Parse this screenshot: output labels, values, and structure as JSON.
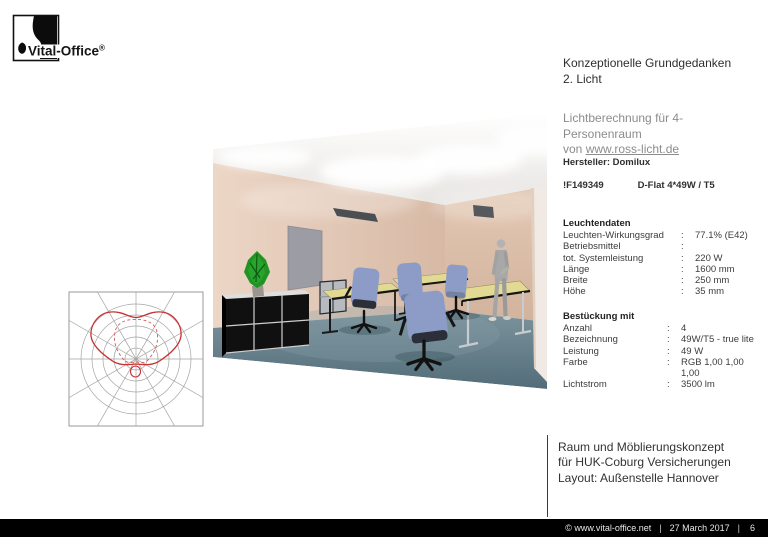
{
  "logo": {
    "text": "Vital-Office",
    "registered": "®"
  },
  "heading": {
    "line1": "Konzeptionelle Grundgedanken",
    "line2": "2. Licht"
  },
  "subtitle": {
    "line1": "Lichtberechnung für 4-Personenraum",
    "line2_prefix": "von ",
    "link": "www.ross-licht.de"
  },
  "product": {
    "manufacturer": "Hersteller: Domilux",
    "code": "!F149349",
    "model": "D-Flat 4*49W / T5"
  },
  "luminaire_data": {
    "heading": "Leuchtendaten",
    "rows": [
      {
        "label": "Leuchten-Wirkungsgrad",
        "sep": ":",
        "value": "77.1% (E42)"
      },
      {
        "label": "Betriebsmittel",
        "sep": ":",
        "value": ""
      },
      {
        "label": "tot. Systemleistung",
        "sep": ":",
        "value": "220 W"
      },
      {
        "label": "Länge",
        "sep": ":",
        "value": "1600 mm"
      },
      {
        "label": "Breite",
        "sep": ":",
        "value": "250 mm"
      },
      {
        "label": "Höhe",
        "sep": ":",
        "value": "35 mm"
      }
    ]
  },
  "equipment": {
    "heading": "Bestückung mit",
    "rows": [
      {
        "label": "Anzahl",
        "sep": ":",
        "value": "4"
      },
      {
        "label": "Bezeichnung",
        "sep": ":",
        "value": "49W/T5 - true lite"
      },
      {
        "label": "Leistung",
        "sep": ":",
        "value": "49 W"
      },
      {
        "label": "Farbe",
        "sep": ":",
        "value": "RGB 1,00 1,00"
      },
      {
        "label": "",
        "sep": "",
        "value": "1,00"
      },
      {
        "label": "Lichtstrom",
        "sep": ":",
        "value": "3500 lm"
      }
    ]
  },
  "footer_block": {
    "line1": "Raum und Möblierungskonzept",
    "line2": "für HUK-Coburg Versicherungen",
    "line3": "Layout: Außenstelle Hannover"
  },
  "bottom_bar": {
    "copyright": "©  www.vital-office.net",
    "date": "27 March 2017",
    "page": "6",
    "separator": "|"
  },
  "polar_diagram": {
    "description": "Luminaire polar light-distribution curve, mainly upward (indirect) lobe",
    "curve_color": "#c83232",
    "dashed_color": "#d05858",
    "grid_color": "#a5a5a5"
  },
  "scene_colors": {
    "wall": "#dcc0ac",
    "floor": "#5d7984",
    "desk": "#e2da93",
    "chair": "#8c9cc6",
    "plant": "#1f9423",
    "door": "#9c9ca4",
    "panel": "#4b4f54"
  }
}
